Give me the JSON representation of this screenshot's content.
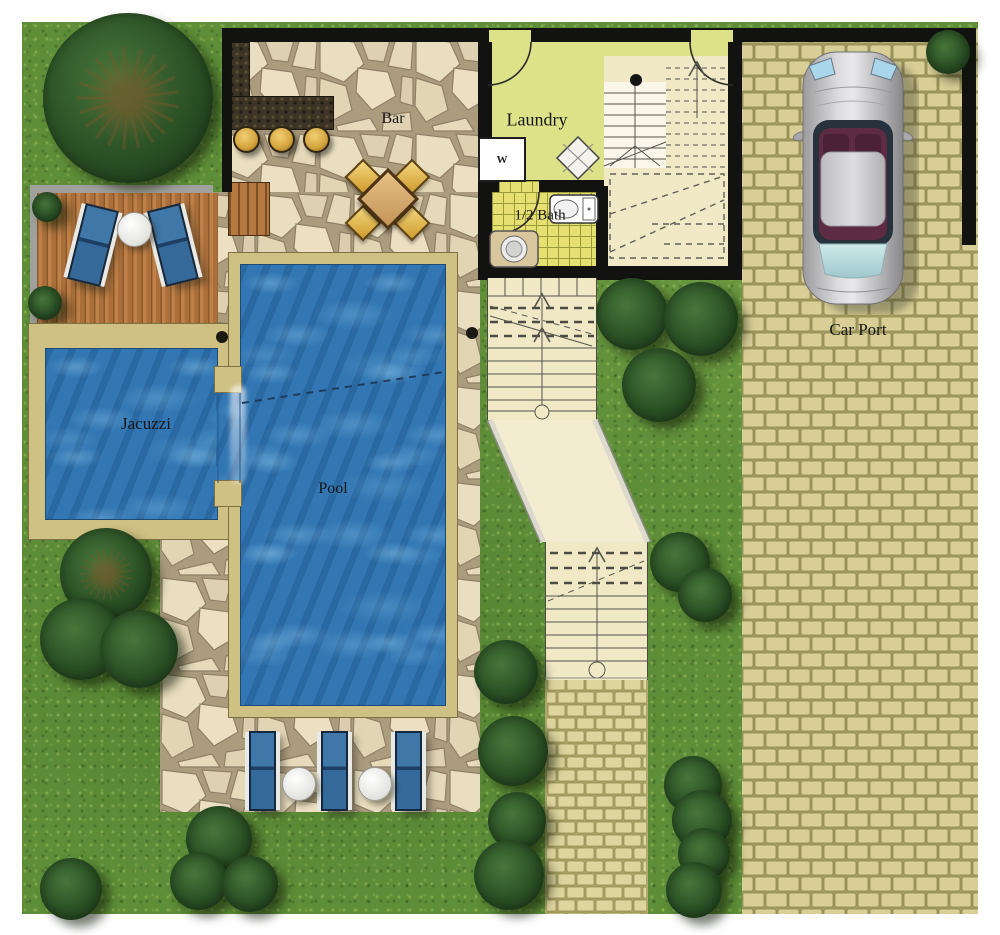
{
  "labels": {
    "bar": "Bar",
    "laundry": "Laundry",
    "half_bath": "1/2 Bath",
    "washer": "W",
    "jacuzzi": "Jacuzzi",
    "pool": "Pool",
    "car_port": "Car Port"
  },
  "colors": {
    "grass": "#5e8e38",
    "pool_water": "#3276b3",
    "flagstone": "#e3d6ba",
    "pebble_border": "#cfc083",
    "deck_wood": "#b77c42",
    "bar_counter": "#3d3425",
    "furniture_gold": "#d9a844",
    "laundry_floor": "#dde289",
    "bath_tile": "#e6df72",
    "stair_path": "#f1e8c6",
    "paver_brick": "#d7cd94",
    "wall": "#121210",
    "lounger_cushion": "#34669a",
    "car_body": "#c6c6c8",
    "tree_foliage": "#2c5226"
  }
}
